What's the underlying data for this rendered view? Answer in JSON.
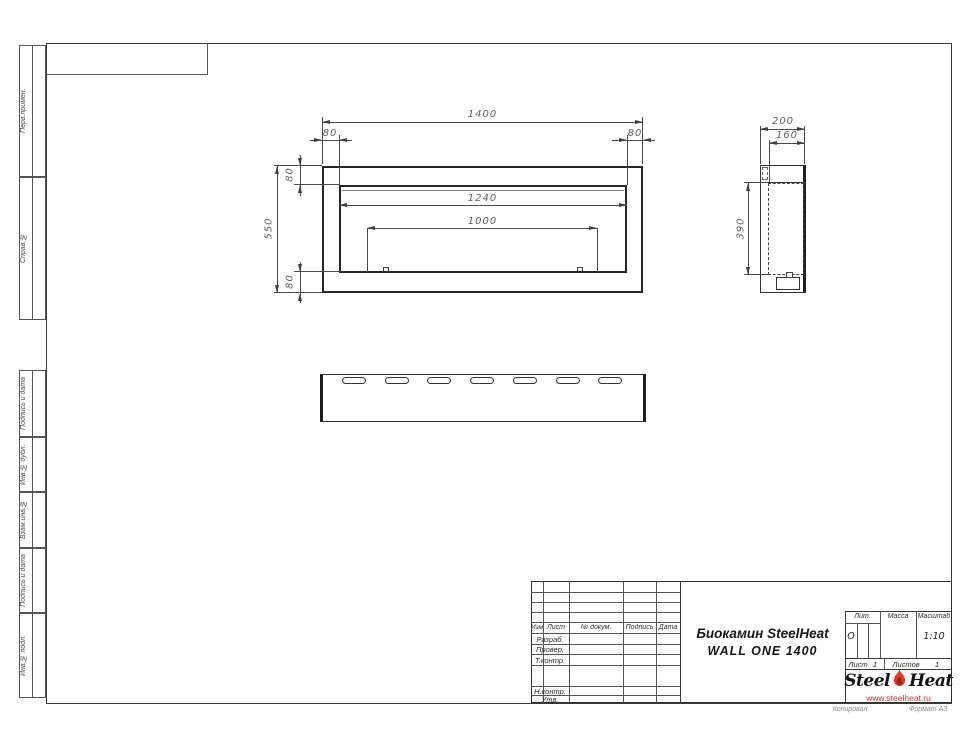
{
  "sheet": {
    "copy_label": "Копировал",
    "format_label": "Формат А3"
  },
  "margin_labels": {
    "perv": "Перв.примен.",
    "sprav": "Справ.№",
    "podp1": "Подпись и дата",
    "inv_dubl": "Инв.№ дубл.",
    "vzam": "Взам.инв.№",
    "podp2": "Подпись и дата",
    "inv_podl": "Инв.№ подл."
  },
  "front_view": {
    "dim_width": "1400",
    "dim_height": "550",
    "dim_left": "80",
    "dim_right": "80",
    "dim_top": "80",
    "dim_bottom": "80",
    "dim_opening": "1240",
    "dim_burner": "1000"
  },
  "side_view": {
    "dim_depth": "200",
    "dim_inner": "160",
    "dim_height": "390"
  },
  "title_block": {
    "col_izm": "Изм.",
    "col_list": "Лист",
    "col_doc": "№ докум.",
    "col_sign": "Подпись",
    "col_date": "Дата",
    "row_razrab": "Разраб.",
    "row_prover": "Провер.",
    "row_tkontr": "Т.контр.",
    "row_nkontr": "Н.контр.",
    "row_utv": "Утв.",
    "title_line1": "Биокамин SteelHeat",
    "title_line2": "WALL ONE 1400",
    "lit_label": "Лит.",
    "lit_value": "О",
    "mass_label": "Масса",
    "scale_label": "Масштаб",
    "scale_value": "1:10",
    "sheet_label": "Лист",
    "sheet_value": "1",
    "sheets_label": "Листов",
    "sheets_value": "1",
    "logo": {
      "steel": "Steel",
      "heat": "Heat",
      "url": "www.steelheat.ru",
      "flame_color": "#e03a28",
      "url_color": "#c5352c"
    }
  }
}
